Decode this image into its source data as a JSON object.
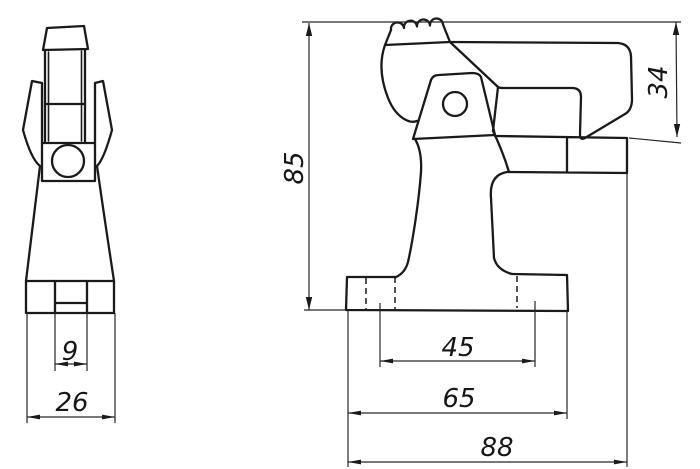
{
  "drawing": {
    "kind": "two-view technical drawing of a toggle clamp",
    "colors": {
      "background": "#ffffff",
      "line": "#1a1a1a"
    },
    "dimensions": {
      "front_view": {
        "slot_width": "9",
        "base_width": "26"
      },
      "side_view": {
        "overall_height": "85",
        "jaw_height": "34",
        "hole_spacing": "45",
        "base_length": "65",
        "overall_length": "88"
      }
    }
  }
}
